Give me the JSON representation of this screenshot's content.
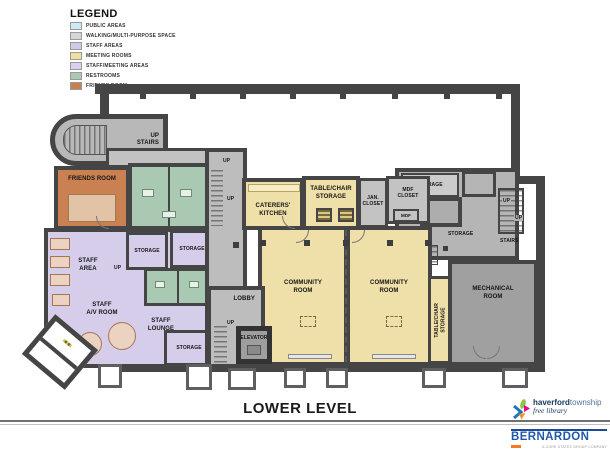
{
  "legend": {
    "title": "LEGEND",
    "items": [
      {
        "label": "PUBLIC AREAS",
        "color": "#cdeaf2"
      },
      {
        "label": "WALKING/MULTI-PURPOSE SPACE",
        "color": "#d6d6d6"
      },
      {
        "label": "STAFF AREAS",
        "color": "#d2c9e6"
      },
      {
        "label": "MEETING ROOMS",
        "color": "#f0dfa2"
      },
      {
        "label": "STAFF/MEETING AREAS",
        "color": "#dacfee"
      },
      {
        "label": "RESTROOMS",
        "color": "#a9c9b3"
      },
      {
        "label": "FRIENDS ROOM",
        "color": "#c8804e"
      }
    ]
  },
  "plan": {
    "title": "LOWER LEVEL",
    "labels": {
      "up": "UP",
      "dn": "DN",
      "stairs": "STAIRS",
      "friends_room": "FRIENDS ROOM",
      "caterers_kitchen": "CATERERS'\nKITCHEN",
      "table_chair_storage": "TABLE/CHAIR\nSTORAGE",
      "jan_closet": "JAN.\nCLOSET",
      "mdf_closet": "MDF\nCLOSET",
      "mdf": "MDF",
      "storage": "STORAGE",
      "community_room": "COMMUNITY\nROOM",
      "mechanical_room": "MECHANICAL\nROOM",
      "staff_area": "STAFF\nAREA",
      "staff_av_room": "STAFF\nA/V ROOM",
      "staff_lounge": "STAFF\nLOUNGE",
      "lobby": "LOBBY",
      "elevator": "ELEVATOR"
    }
  },
  "footer": {
    "haverford": {
      "name_bold": "haverford",
      "name_regular": "township",
      "tagline": "free library"
    },
    "bernardon": {
      "name": "BERNARDON",
      "tagline": "A CORE STATES GROUP COMPANY"
    }
  },
  "colors": {
    "wall": "#454545",
    "walkway_gray": "#bdbdbd",
    "meeting_yellow": "#efdfa9",
    "staff_purple": "#d6cdea",
    "restroom_green": "#a9c9b3",
    "friends_orange": "#ca8152",
    "mechanical_gray": "#a0a0a0"
  }
}
